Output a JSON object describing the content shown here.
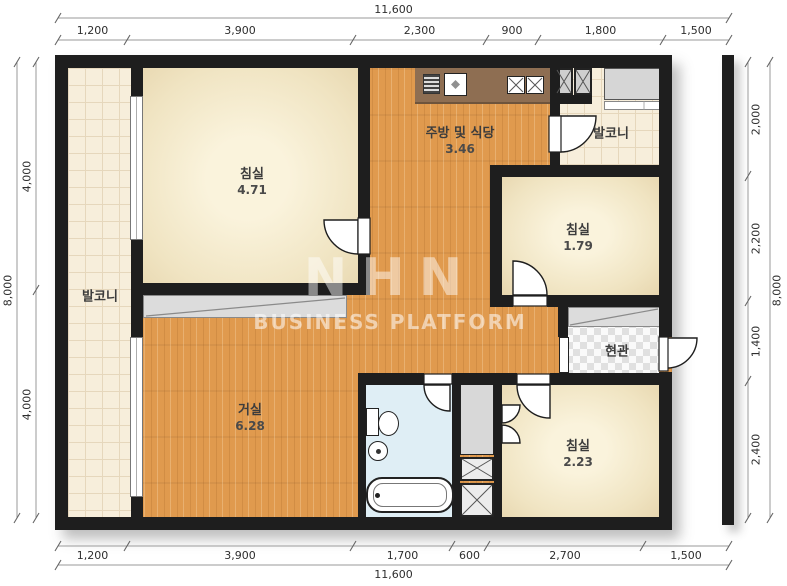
{
  "watermark": {
    "logo": "NHN",
    "subtitle": "BUSINESS PLATFORM"
  },
  "rooms": {
    "bedroom_top_left": {
      "label": "침실",
      "area": "4.71"
    },
    "kitchen_dining": {
      "label": "주방 및 식당",
      "area": "3.46"
    },
    "balcony_top_right": {
      "label": "발코니"
    },
    "bedroom_mid_right": {
      "label": "침실",
      "area": "1.79"
    },
    "balcony_left": {
      "label": "발코니"
    },
    "living_room": {
      "label": "거실",
      "area": "6.28"
    },
    "entrance": {
      "label": "현관"
    },
    "bedroom_bottom_right": {
      "label": "침실",
      "area": "2.23"
    }
  },
  "dimensions": {
    "top": {
      "total": "11,600",
      "segments": [
        "1,200",
        "3,900",
        "2,300",
        "900",
        "1,800",
        "1,500"
      ]
    },
    "bottom": {
      "total": "11,600",
      "segments": [
        "1,200",
        "3,900",
        "1,700",
        "600",
        "2,700",
        "1,500"
      ]
    },
    "left": {
      "total": "8,000",
      "segments": [
        "4,000",
        "4,000"
      ]
    },
    "right": {
      "total": "8,000",
      "segments": [
        "2,000",
        "2,200",
        "1,400",
        "2,400"
      ]
    }
  },
  "colors": {
    "wall": "#1e1e1e",
    "wood_floor": "#e09a4e",
    "bedroom_floor": "#f3e9cf",
    "balcony_tile": "#f7eedb",
    "bathroom_floor": "#dfeef5",
    "kitchen_counter": "#8e6e52",
    "closet_gray": "#dcdcdc",
    "dimension_text": "#2e2e2e"
  }
}
